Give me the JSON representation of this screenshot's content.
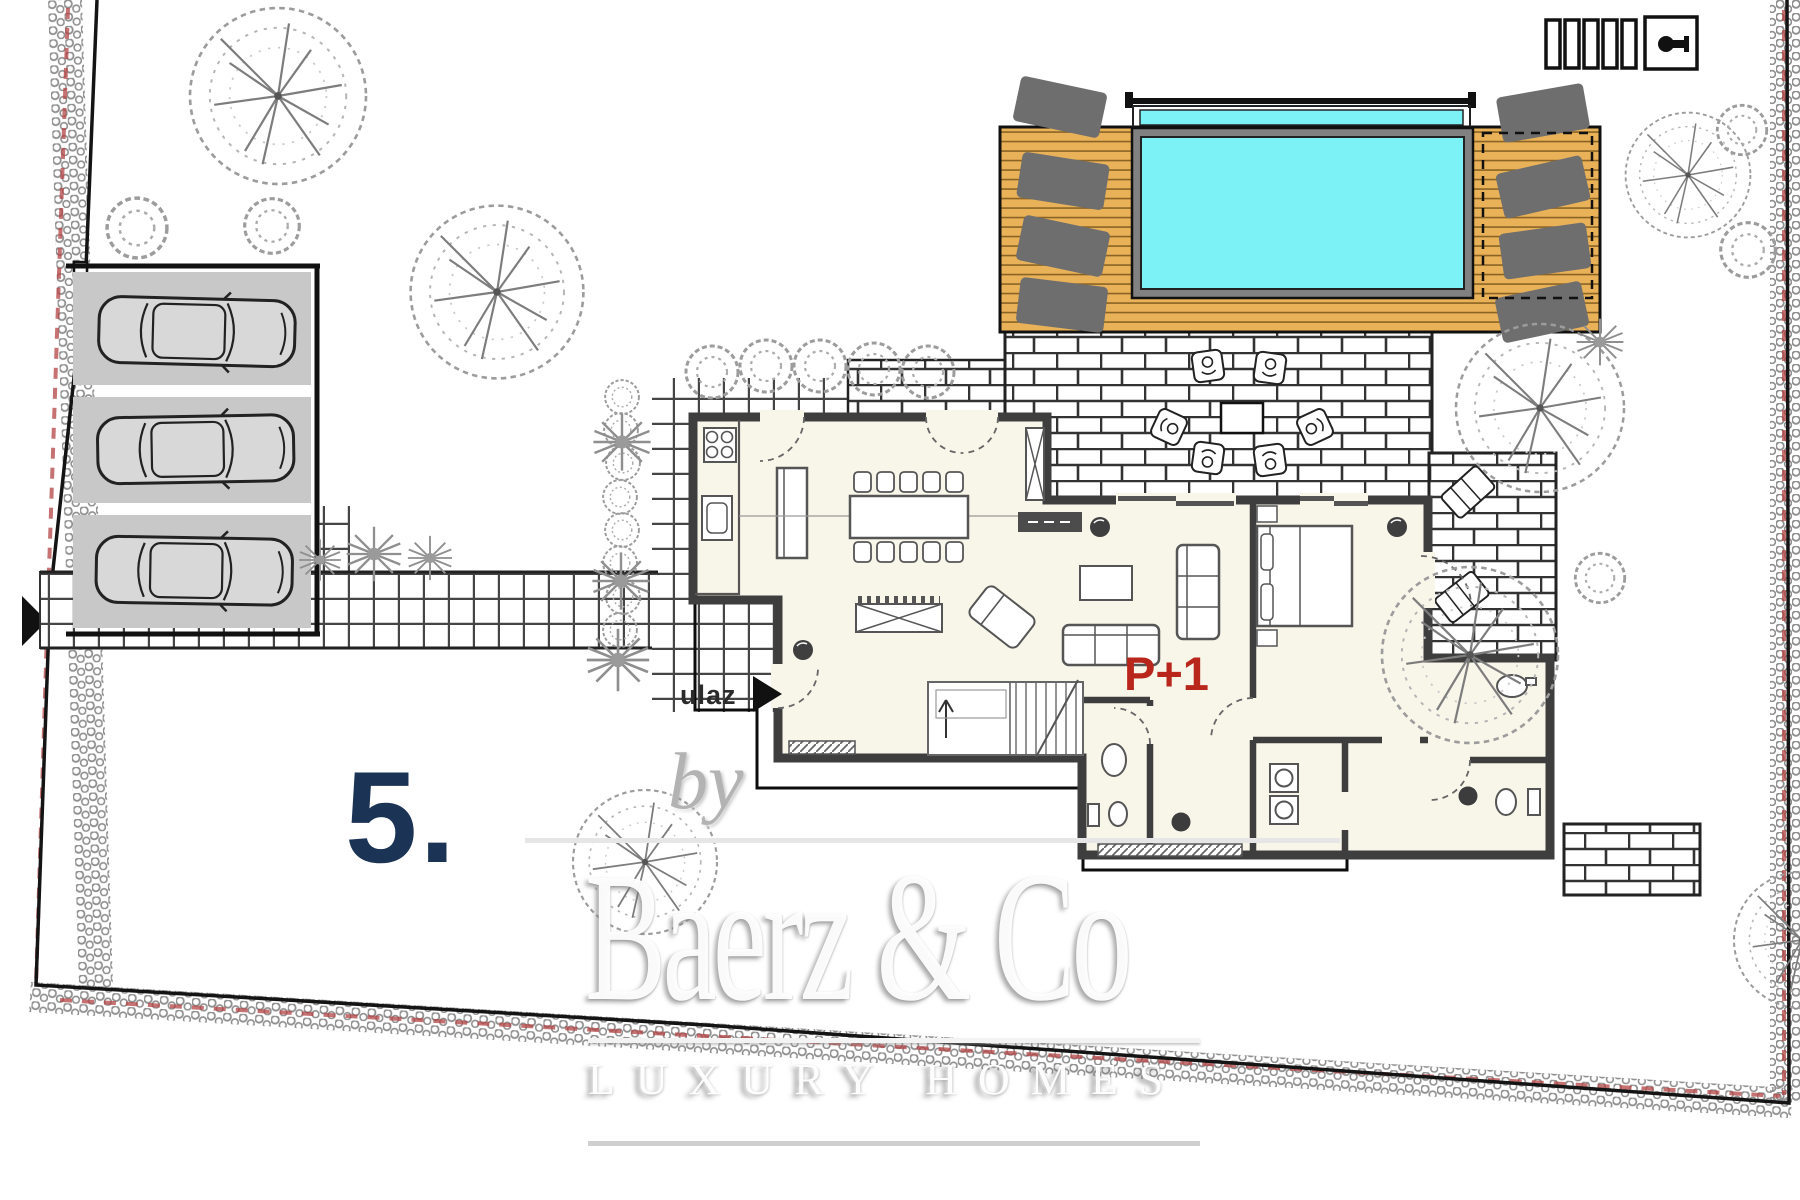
{
  "plan": {
    "unit_label": "5.",
    "floor_label": "P+1",
    "entrance_label": "ulaz"
  },
  "watermark": {
    "by": "by",
    "name": "Baerz & Co",
    "tagline": "LUXURY HOMES"
  },
  "legend": {
    "scale_bar_segments": 5
  },
  "site": {
    "parking_cars": 3,
    "deck_sun_loungers": 8,
    "patio_chairs": 6,
    "dining_chairs": 10
  },
  "colors": {
    "pool-water": "#7df2f6",
    "pool-rim": "#818181",
    "deck-wood": "#eab258",
    "deck-line": "#8a6426",
    "floor-cream": "#f8f5e9",
    "wall-gray": "#3e3e3e",
    "ink": "#111111",
    "parking-gray": "#c8c8c8",
    "lounger-gray": "#6e6e6e",
    "unit-navy": "#1b3354",
    "floor-red": "#b9271c",
    "hedge-gray": "#8f8f8f",
    "hedge-red": "#b34343",
    "tree-gray": "#9c9c9c",
    "brick-line": "#333333",
    "tile-line": "#454545",
    "furniture-line": "#555555",
    "watermark-shadow": "#9a9a9a"
  }
}
